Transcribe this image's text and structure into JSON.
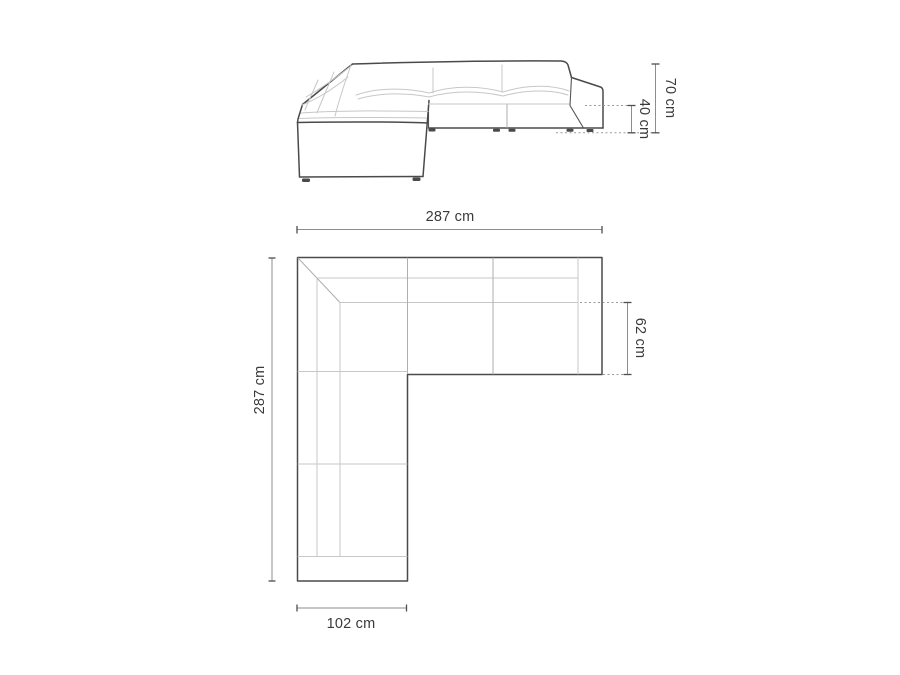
{
  "colors": {
    "background": "#ffffff",
    "outline": "#4a4a4a",
    "seam": "#c7c7c7",
    "dimension_line": "#8d8d8d",
    "dotted_line": "#9b9b9b",
    "label_text": "#3a3a3a"
  },
  "elevation": {
    "total_height": "70 cm",
    "seat_height": "40 cm"
  },
  "plan": {
    "total_width": "287 cm",
    "total_depth": "287 cm",
    "seat_depth": "62 cm",
    "chaise_width": "102 cm"
  }
}
